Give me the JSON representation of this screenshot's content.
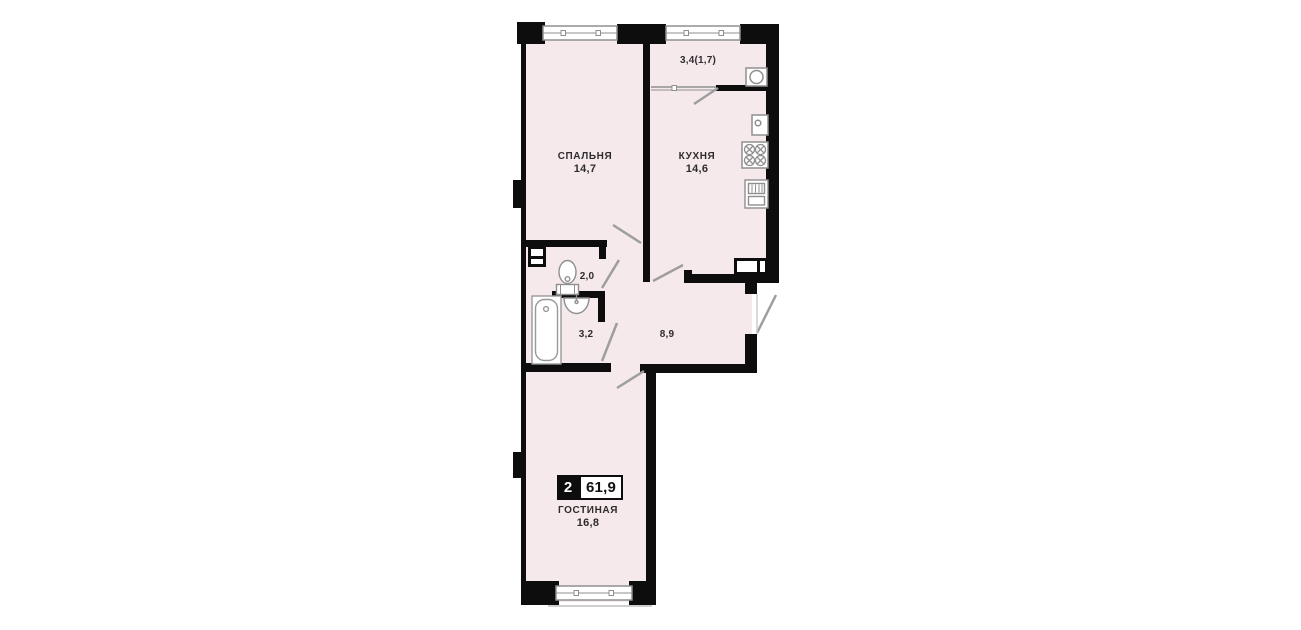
{
  "plan": {
    "badge": {
      "rooms": "2",
      "total_area": "61,9"
    },
    "rooms": {
      "bedroom": {
        "name": "СПАЛЬНЯ",
        "area": "14,7"
      },
      "kitchen": {
        "name": "КУХНЯ",
        "area": "14,6"
      },
      "balcony": {
        "area": "3,4(1,7)"
      },
      "toilet": {
        "area": "2,0"
      },
      "bathroom": {
        "area": "3,2"
      },
      "hallway": {
        "area": "8,9"
      },
      "living": {
        "name": "ГОСТИНАЯ",
        "area": "16,8"
      }
    },
    "colors": {
      "wall": "#0d0d0d",
      "room_fill": "#f6e9ec",
      "fixture_line": "#8f8f8f",
      "door_line": "#9e9e9e",
      "text": "#2d2d2d",
      "badge_bg": "#0d0d0d",
      "badge_text": "#ffffff"
    },
    "fixtures": [
      "window",
      "vent-shaft",
      "balcony-sink",
      "kitchen-sink",
      "stove",
      "fridge",
      "toilet",
      "wash-basin",
      "bathtub",
      "door-swing"
    ]
  }
}
